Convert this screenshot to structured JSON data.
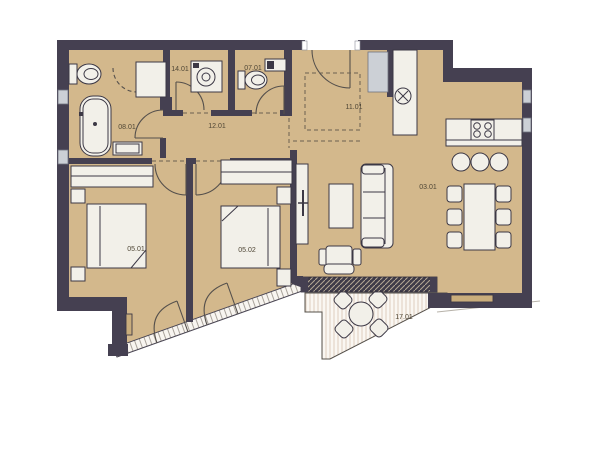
{
  "colors": {
    "wall": "#454051",
    "floor": "#d3b88c",
    "fixture": "#f2f0e9",
    "fixture_border": "#3c3845",
    "window": "#ccd0d6",
    "terrace_bg": "#faf7f2",
    "terrace_stripe": "#e2d4c7",
    "label": "#4f4635",
    "background": "#ffffff",
    "door": "#55504c"
  },
  "rooms": [
    {
      "id": "08.01",
      "name": "bathroom"
    },
    {
      "id": "14.01",
      "name": "utility-room"
    },
    {
      "id": "07.01",
      "name": "wc"
    },
    {
      "id": "12.01",
      "name": "hallway"
    },
    {
      "id": "11.01",
      "name": "entry"
    },
    {
      "id": "03.01",
      "name": "living-kitchen-dining"
    },
    {
      "id": "05.01",
      "name": "bedroom-1"
    },
    {
      "id": "05.02",
      "name": "bedroom-2"
    },
    {
      "id": "17.01",
      "name": "terrace"
    }
  ]
}
